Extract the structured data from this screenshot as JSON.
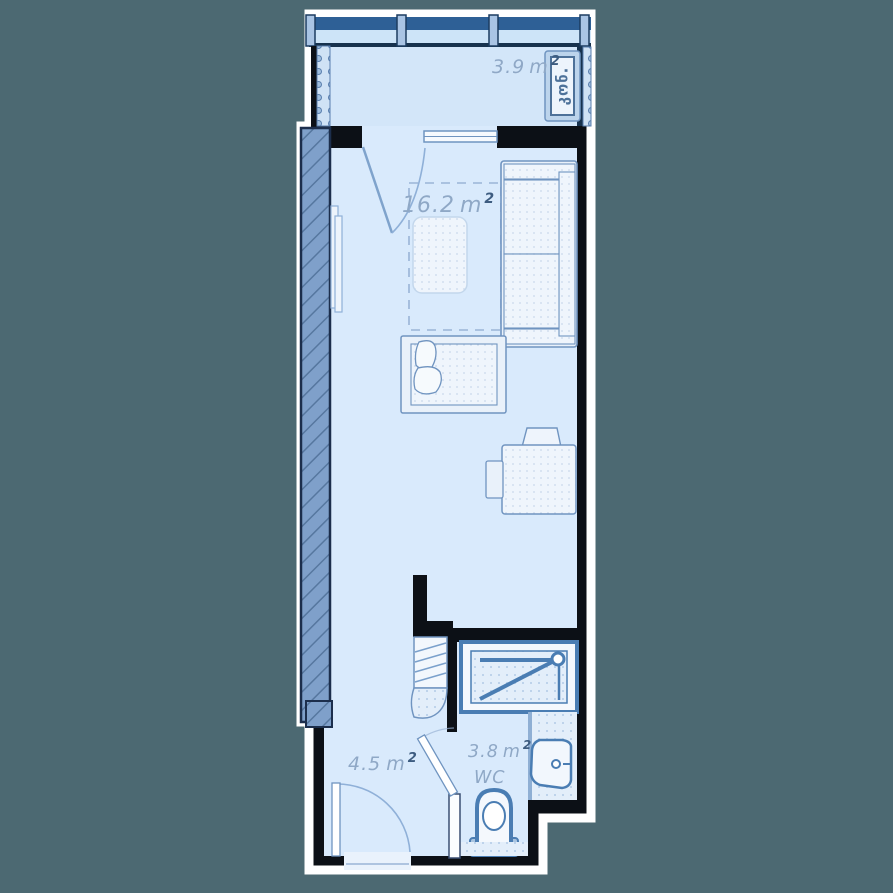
{
  "title": "apartment-floor-plan",
  "rooms": {
    "balcony": {
      "area": "3.9"
    },
    "living": {
      "area": "16.2"
    },
    "hall": {
      "area": "4.5"
    },
    "wc": {
      "area": "3.8",
      "name": "WC"
    }
  },
  "units": {
    "base": "m",
    "sup": "2"
  },
  "equipment": {
    "ac_label": "კონ."
  },
  "colors": {
    "background": "#4c6972",
    "wall": "#0c1016",
    "halo": "#ffffff",
    "room_fill": "#d9eafc",
    "balcony_fill": "#d3e6f9",
    "structural_wall": "#7fa0ca",
    "fixture_stroke": "#4a7db3",
    "furniture_stroke": "#7094c0",
    "label_text": "#8fa8c6",
    "window_band": "#2e6096"
  }
}
